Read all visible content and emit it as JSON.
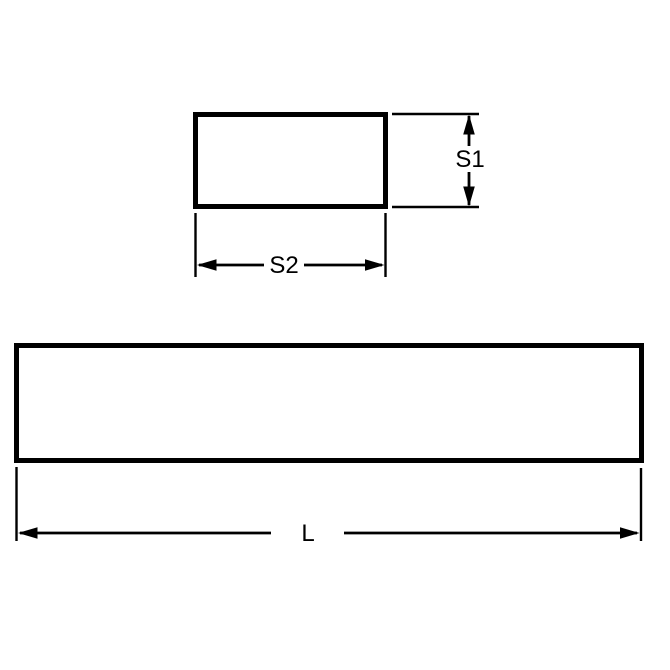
{
  "colors": {
    "ink": "#000000",
    "background": "#ffffff"
  },
  "drawing": {
    "cross_section_view": {
      "height_dimension_label": "S1",
      "width_dimension_label": "S2"
    },
    "side_view": {
      "length_dimension_label": "L"
    }
  }
}
